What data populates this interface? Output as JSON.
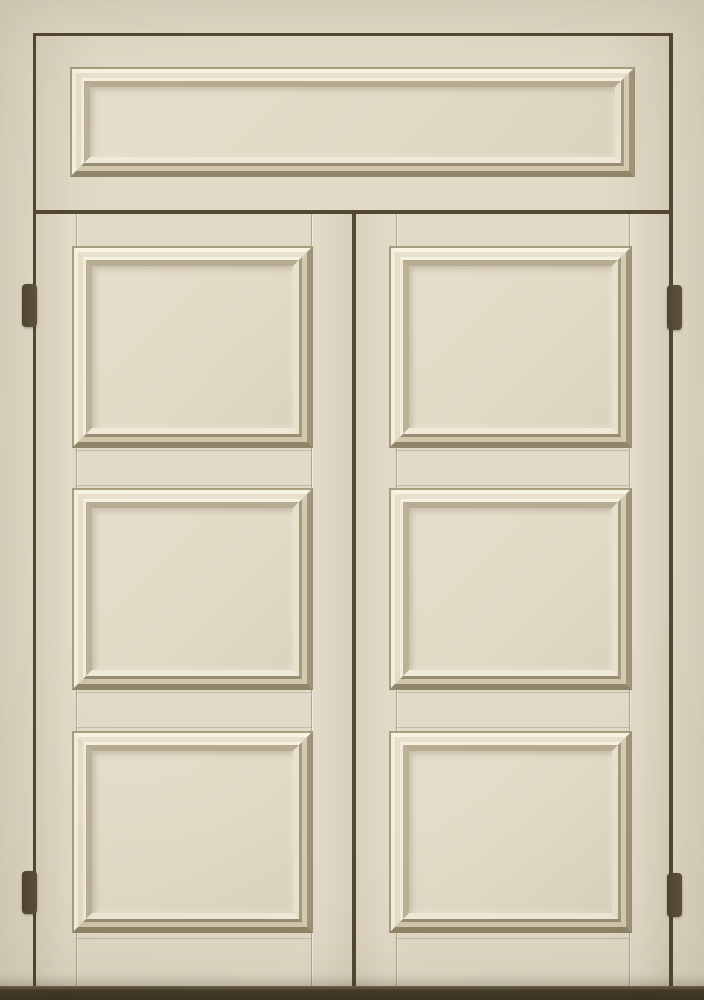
{
  "scene": {
    "type": "product-photo",
    "subject": "Double panel door with transom",
    "description": "Cream-painted double door photographed straight on; each leaf has three raised square panels with stepped moldings; a wide raised transom panel sits above both leaves; dark reveal gaps outline the frame, transom and the meeting of the two leaves; two dark bronze hinges on each outer edge; dark floor strip along the bottom."
  },
  "door": {
    "transom": {
      "name": "transom",
      "panel_count": 1
    },
    "leaves": [
      {
        "name": "left-leaf",
        "panel_count": 3,
        "hinge_count": 2
      },
      {
        "name": "right-leaf",
        "panel_count": 3,
        "hinge_count": 2
      }
    ],
    "hardware": {
      "hinges": 4,
      "handles": 0
    }
  },
  "colors": {
    "base": "#ded6c1",
    "panel-field": "#dfd8c2",
    "molding-highlight": "#f5f1e0",
    "molding-shadow": "#8f8265",
    "crevice": "#a49778",
    "reveal": "#4a3e27",
    "hinge-dark": "#463b27",
    "hinge-light": "#574a33",
    "threshold": "#382e1e"
  }
}
